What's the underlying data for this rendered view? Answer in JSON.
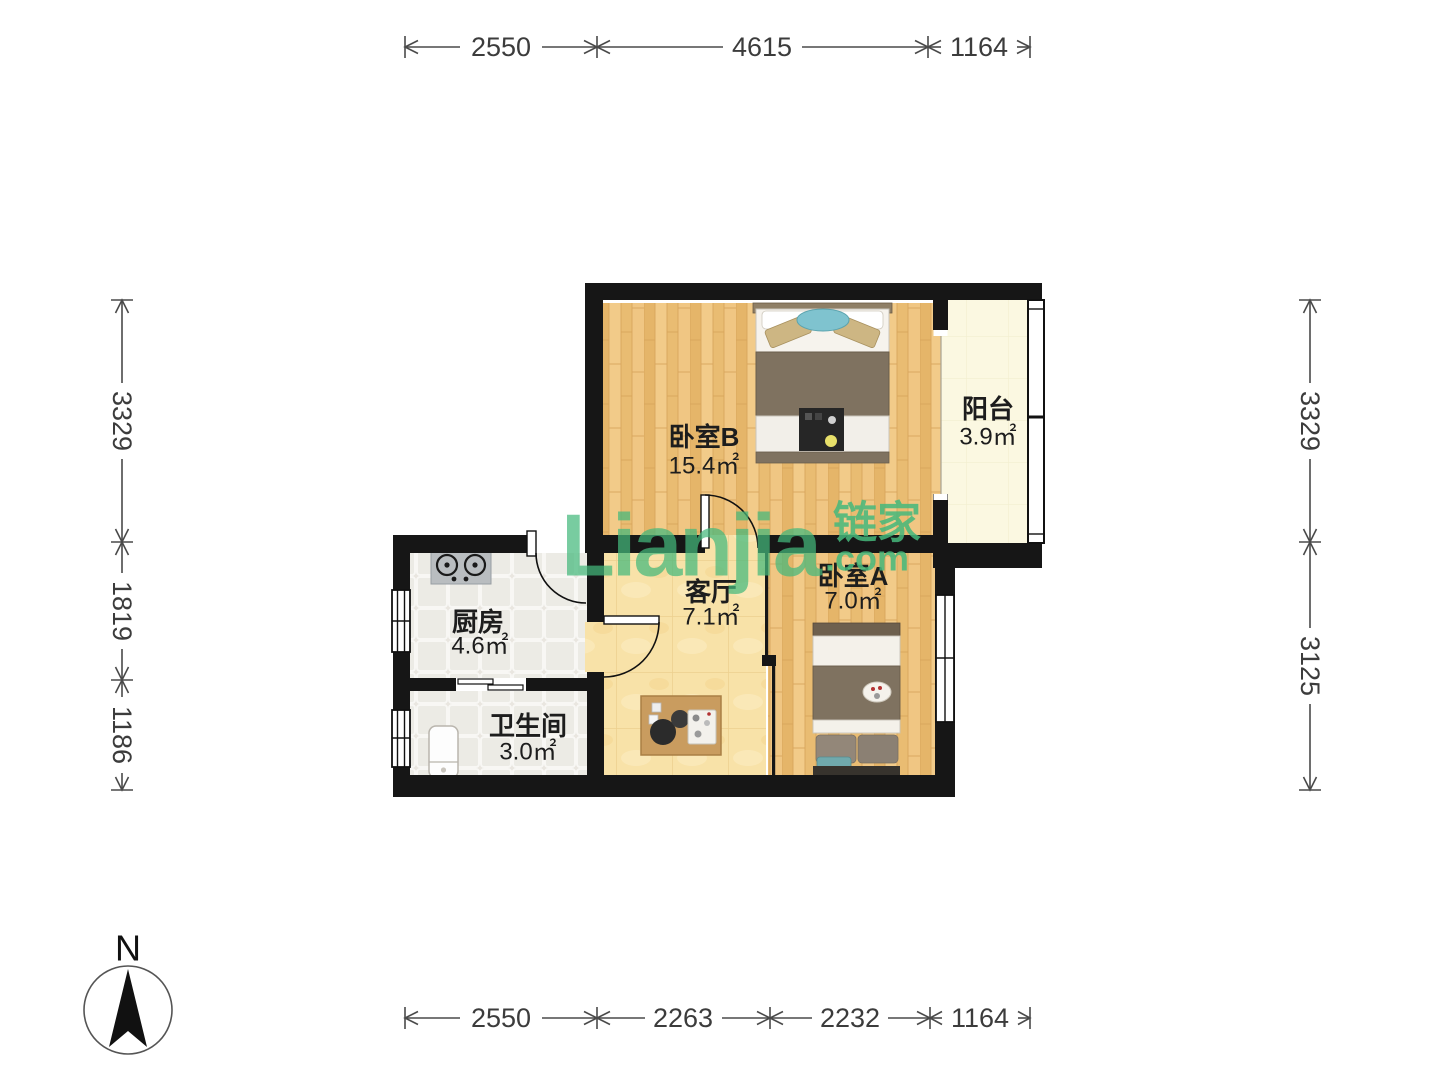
{
  "watermark": {
    "brand": "Lianjia",
    "brand_cjk": "链家",
    "tld": ".com"
  },
  "compass": {
    "label": "N"
  },
  "rooms": [
    {
      "id": "bedroom-b",
      "name": "卧室B",
      "area": "15.4㎡"
    },
    {
      "id": "balcony",
      "name": "阳台",
      "area": "3.9㎡"
    },
    {
      "id": "kitchen",
      "name": "厨房",
      "area": "4.6㎡"
    },
    {
      "id": "living",
      "name": "客厅",
      "area": "7.1㎡"
    },
    {
      "id": "bedroom-a",
      "name": "卧室A",
      "area": "7.0㎡"
    },
    {
      "id": "bathroom",
      "name": "卫生间",
      "area": "3.0㎡"
    }
  ],
  "dimensions": {
    "top": [
      "2550",
      "4615",
      "1164"
    ],
    "bottom": [
      "2550",
      "2263",
      "2232",
      "1164"
    ],
    "left": [
      "3329",
      "1819",
      "1186"
    ],
    "right": [
      "3329",
      "3125"
    ]
  }
}
